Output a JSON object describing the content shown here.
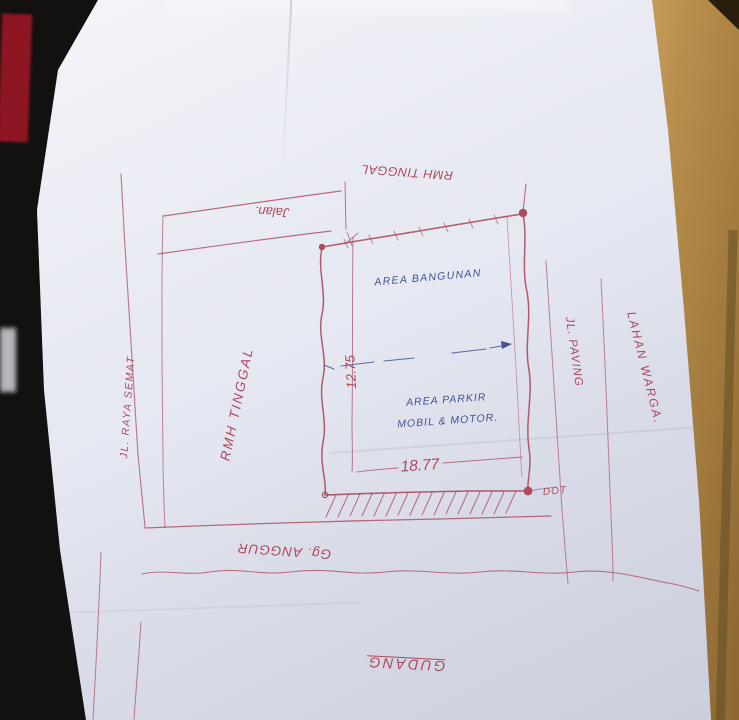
{
  "ink": {
    "red": "#ad4a5c",
    "blue": "#44528f"
  },
  "surface": {
    "paper": "#e6e8f2",
    "wood": "#b18543",
    "background": "#131110",
    "red_object": "#8d1622",
    "gray_object": "#c7c9ce"
  },
  "plot": {
    "building_area": "AREA BANGUNAN",
    "parking_area_line1": "AREA PARKIR",
    "parking_area_line2": "MOBIL & MOTOR.",
    "width_dimension": "12.75",
    "length_dimension": "18.77",
    "corner_marker": "DOT"
  },
  "surroundings": {
    "north_neighbor": "RMH TINGGAL",
    "north_road": "Jalan.",
    "west_road": "JL. RAYA SEMAT",
    "west_neighbor": "RMH TINGGAL",
    "east_road": "JL. PAVING",
    "east_neighbor": "LAHAN WARGA.",
    "south_road": "Gg. ANGGUR",
    "south_building": "GUDANG"
  }
}
